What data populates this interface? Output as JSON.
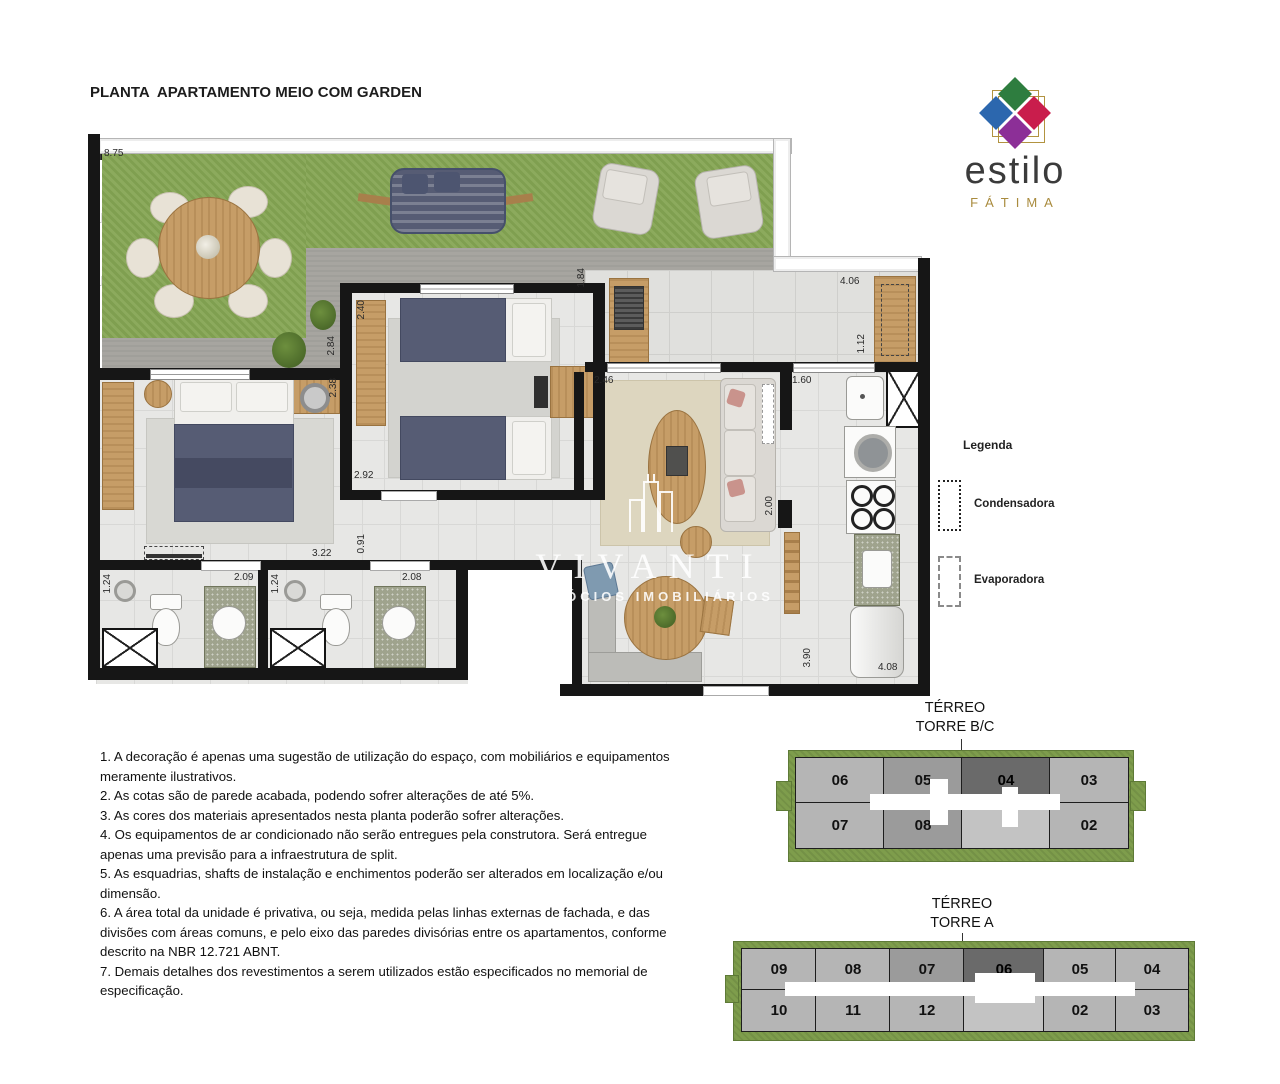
{
  "header": {
    "line1": "PLANTA  APARTAMENTO MEIO COM GARDEN",
    "line2": "TÉRREO TORRE A/B/C",
    "line3": "ÁREA PRIVATIVA: 48.18m²",
    "line4": "ÁREA GARDEN: 21.58m²"
  },
  "logo": {
    "brand": "estilo",
    "sub": "FÁTIMA"
  },
  "legend": {
    "title": "Legenda",
    "item1": "Condensadora",
    "item2": "Evaporadora"
  },
  "watermark": {
    "name": "VIVANTI",
    "sub": "NEGÓCIOS IMOBILIÁRIOS"
  },
  "notes": [
    "1. A decoração é apenas uma sugestão de utilização do espaço, com mobiliários e equipamentos meramente ilustrativos.",
    "2. As cotas são de parede acabada, podendo sofrer alterações de até 5%.",
    "3. As cores dos materiais apresentados nesta planta poderão sofrer alterações.",
    "4. Os equipamentos de ar condicionado não serão entregues pela construtora. Será entregue apenas uma previsão para a infraestrutura de split.",
    "5. As esquadrias, shafts de instalação e enchimentos poderão ser alterados em localização e/ou dimensão.",
    "6. A área total da unidade é privativa, ou seja, medida pelas linhas externas de fachada, e das divisões com áreas comuns, e pelo eixo das paredes divisórias entre os apartamentos, conforme descrito na NBR 12.721 ABNT.",
    "7. Demais detalhes dos revestimentos a serem utilizados estão especificados no memorial de especificação."
  ],
  "plan": {
    "dims": [
      "8.75",
      "2.40",
      "2.84",
      "2.38",
      "2.92",
      "0.91",
      "3.22",
      "2.09",
      "1.24",
      "1.24",
      "2.08",
      "2.46",
      "1.84",
      "4.06",
      "1.12",
      "1.60",
      "2.00",
      "3.90",
      "4.08"
    ]
  },
  "towers": {
    "bc": {
      "t1": "TÉRREO",
      "t2": "TORRE B/C",
      "u1": "06",
      "u2": "05",
      "u3": "04",
      "u4": "03",
      "u5": "07",
      "u6": "08",
      "u7": "02"
    },
    "a": {
      "t1": "TÉRREO",
      "t2": "TORRE A",
      "u1": "09",
      "u2": "08",
      "u3": "07",
      "u4": "06",
      "u5": "05",
      "u6": "04",
      "u7": "10",
      "u8": "11",
      "u9": "12",
      "u10": "02",
      "u11": "03"
    }
  },
  "colors": {
    "logo_green": "#2e7d3f",
    "logo_blue": "#2c67ae",
    "logo_red": "#c91d4c",
    "logo_purple": "#8c2f97",
    "gold": "#b29340",
    "grass": "#86a654",
    "highlight_unit": "#6a6a6a"
  }
}
